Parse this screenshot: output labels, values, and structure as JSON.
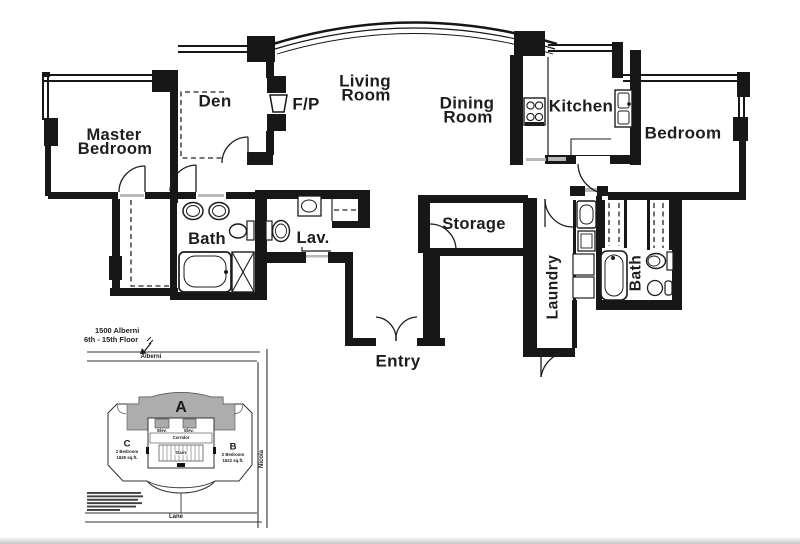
{
  "floor_plan": {
    "rooms": {
      "master_bedroom": {
        "line1": "Master",
        "line2": "Bedroom"
      },
      "den": "Den",
      "fireplace": "F/P",
      "living_room": {
        "line1": "Living",
        "line2": "Room"
      },
      "dining_room": {
        "line1": "Dining",
        "line2": "Room"
      },
      "kitchen": "Kitchen",
      "bedroom": "Bedroom",
      "bath_left": "Bath",
      "lav": "Lav.",
      "storage": "Storage",
      "laundry": "Laundry",
      "bath_right": "Bath",
      "entry": "Entry"
    }
  },
  "site_plan": {
    "address_line1": "1500 Alberni",
    "address_line2": "6th - 15th Floor",
    "street_top": "Alberni",
    "street_right": "Nicola",
    "street_bottom": "Lane",
    "unit_a": {
      "label": "A"
    },
    "unit_b": {
      "label": "B",
      "type": "2 Bedroom",
      "area": "1622 sq.ft."
    },
    "unit_c": {
      "label": "C",
      "type": "2 Bedroom",
      "area": "1626 sq.ft."
    },
    "core": {
      "elev1": "Elev.",
      "elev2": "Elev.",
      "corridor": "Corridor",
      "stairs": "Stairs"
    }
  },
  "colors": {
    "wall": "#171717",
    "line": "#222222",
    "shade": "#adadad",
    "threshold": "#b9b9b9",
    "paper": "#ffffff"
  }
}
